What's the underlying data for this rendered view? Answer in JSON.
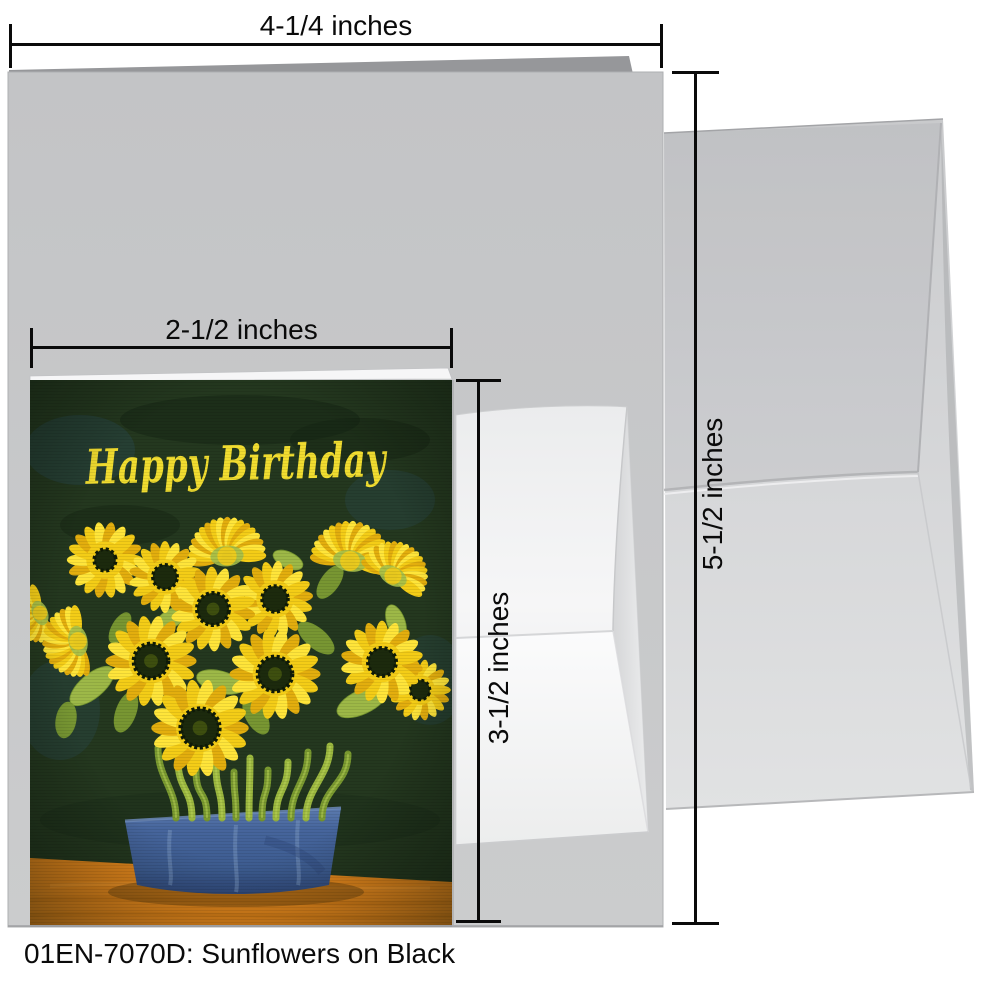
{
  "caption": "01EN-7070D: Sunflowers on Black",
  "card": {
    "greeting": "Happy Birthday",
    "artwork_title": "Sunflowers on Black"
  },
  "dimensions": {
    "large_width": "4-1/4 inches",
    "large_height": "5-1/2 inches",
    "preview_width": "2-1/2 inches",
    "preview_height": "3-1/2 inches"
  },
  "artwork": {
    "palette": {
      "bg": "#24381f",
      "bgBlue": "#2a5062",
      "bgDark": "#152312",
      "greeting": "#f1dd30",
      "petal": "#f4cd17",
      "petalLight": "#ffe53a",
      "petalDeep": "#e3ae0e",
      "center": "#1c2a0d",
      "centerEdge": "#0f1a07",
      "centerHighlight": "#42530f",
      "stem": "#9cb83f",
      "stemDark": "#7a9a30",
      "stemLight": "#bcd45a",
      "leaf": "#7d9c34",
      "leafLight": "#a4bf4a",
      "table": "#e0851b",
      "tableDark": "#c06f10",
      "tableLight": "#f29a2e",
      "tableShadow": "#744a10",
      "potTop": "#5c7bae",
      "pot": "#3d5c90",
      "potLight": "#7e9cc4",
      "potDark": "#30497a",
      "potRim": "#6c8ab8"
    },
    "flowers": [
      {
        "x": 197,
        "y": 176,
        "r": 37,
        "rot": -95,
        "type": "side"
      },
      {
        "x": 320,
        "y": 181,
        "r": 38,
        "rot": -80,
        "type": "side"
      },
      {
        "x": 363,
        "y": 196,
        "r": 33,
        "rot": -60,
        "type": "side"
      },
      {
        "x": 75,
        "y": 180,
        "r": 36,
        "rot": -20,
        "type": "front",
        "c": 0.3
      },
      {
        "x": 135,
        "y": 197,
        "r": 34,
        "rot": 10,
        "type": "front",
        "c": 0.36
      },
      {
        "x": 245,
        "y": 219,
        "r": 36,
        "rot": -5,
        "type": "front",
        "c": 0.36
      },
      {
        "x": 183,
        "y": 229,
        "r": 40,
        "rot": 8,
        "type": "front",
        "c": 0.4
      },
      {
        "x": 10,
        "y": 233,
        "r": 28,
        "rot": 160,
        "type": "side"
      },
      {
        "x": 48,
        "y": 261,
        "r": 34,
        "rot": 170,
        "type": "side"
      },
      {
        "x": 390,
        "y": 310,
        "r": 29,
        "rot": 20,
        "type": "front",
        "c": 0.34
      },
      {
        "x": 352,
        "y": 282,
        "r": 39,
        "rot": 10,
        "type": "front",
        "c": 0.36
      },
      {
        "x": 121,
        "y": 281,
        "r": 43,
        "rot": 0,
        "type": "front",
        "c": 0.4
      },
      {
        "x": 245,
        "y": 294,
        "r": 43,
        "rot": 0,
        "type": "front",
        "c": 0.4
      },
      {
        "x": 170,
        "y": 348,
        "r": 46,
        "rot": 0,
        "type": "front",
        "c": 0.42
      }
    ],
    "leaves": [
      {
        "x": 62,
        "y": 306,
        "rx": 27,
        "ry": 12,
        "rot": -40
      },
      {
        "x": 96,
        "y": 332,
        "rx": 21,
        "ry": 10,
        "rot": -70
      },
      {
        "x": 190,
        "y": 302,
        "rx": 24,
        "ry": 11,
        "rot": 15
      },
      {
        "x": 286,
        "y": 258,
        "rx": 22,
        "ry": 10,
        "rot": 40
      },
      {
        "x": 332,
        "y": 322,
        "rx": 27,
        "ry": 12,
        "rot": -25
      },
      {
        "x": 226,
        "y": 336,
        "rx": 20,
        "ry": 10,
        "rot": 60
      },
      {
        "x": 142,
        "y": 238,
        "rx": 18,
        "ry": 9,
        "rot": -30
      },
      {
        "x": 300,
        "y": 202,
        "rx": 19,
        "ry": 9,
        "rot": -55
      },
      {
        "x": 366,
        "y": 242,
        "rx": 18,
        "ry": 9,
        "rot": 70
      },
      {
        "x": 36,
        "y": 340,
        "rx": 18,
        "ry": 10,
        "rot": -80
      },
      {
        "x": 258,
        "y": 180,
        "rx": 16,
        "ry": 8,
        "rot": 25
      },
      {
        "x": 90,
        "y": 248,
        "rx": 17,
        "ry": 8,
        "rot": -60
      }
    ],
    "stems": [
      {
        "x1": 128,
        "x2": 146,
        "y1": 368
      },
      {
        "x1": 148,
        "x2": 162,
        "y1": 380
      },
      {
        "x1": 166,
        "x2": 177,
        "y1": 390
      },
      {
        "x1": 186,
        "x2": 192,
        "y1": 384
      },
      {
        "x1": 204,
        "x2": 206,
        "y1": 392
      },
      {
        "x1": 220,
        "x2": 219,
        "y1": 378
      },
      {
        "x1": 238,
        "x2": 232,
        "y1": 390
      },
      {
        "x1": 258,
        "x2": 246,
        "y1": 382
      },
      {
        "x1": 278,
        "x2": 261,
        "y1": 372
      },
      {
        "x1": 300,
        "x2": 276,
        "y1": 366
      },
      {
        "x1": 318,
        "x2": 292,
        "y1": 374
      }
    ]
  }
}
